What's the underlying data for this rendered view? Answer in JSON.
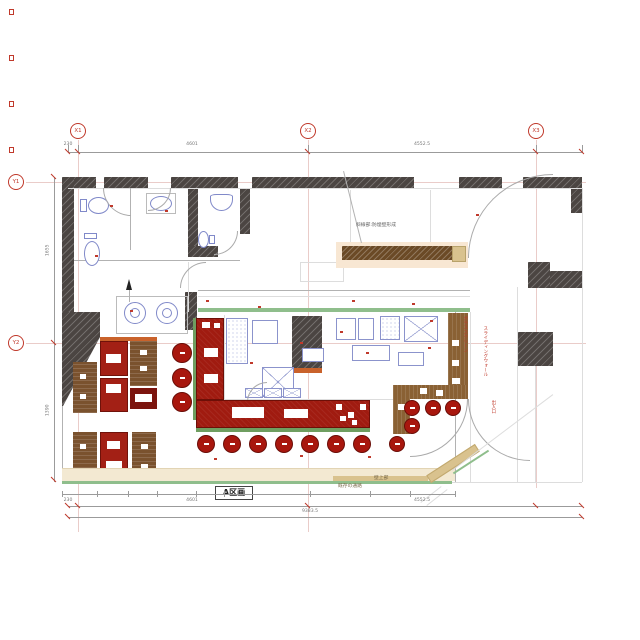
{
  "grid": {
    "x_labels": [
      "X1",
      "X2",
      "X3"
    ],
    "y_labels": [
      "Y1",
      "Y2"
    ]
  },
  "area_label": "A区画",
  "notes": {
    "hatch_note": "斜線部:防煙壁形成",
    "corridor_note": "既存の通路",
    "wall_top_note": "壁上部",
    "right_note_1": "ガラススクリーン",
    "right_note_2": "スライディングウォール",
    "right_note_3": "出入口"
  },
  "dimensions": {
    "top": [
      "230",
      "4601",
      "4552.5"
    ],
    "bottom": [
      "230",
      "4601",
      "4552.5"
    ],
    "bottom_total": "9383.5",
    "left": [
      "1655",
      "1390"
    ]
  },
  "furniture_counts": {
    "bottom_counter_stools": 7,
    "right_counter_stools": 5,
    "left_round_stools": 3,
    "left_tables": 4,
    "left_bench_columns": 5
  },
  "legend_colors": {
    "wall": "#4b4542",
    "counter_red": "#a01b10",
    "table_red": "#a32015",
    "stool_red": "#a8170e",
    "bench_brown": "#7a522e",
    "counter_brown": "#8a6134",
    "accent_green": "#6f9e60",
    "floor_beige": "#f3e9d2",
    "fixture_blue": "#8089c9",
    "marker_red": "#c0392b"
  }
}
